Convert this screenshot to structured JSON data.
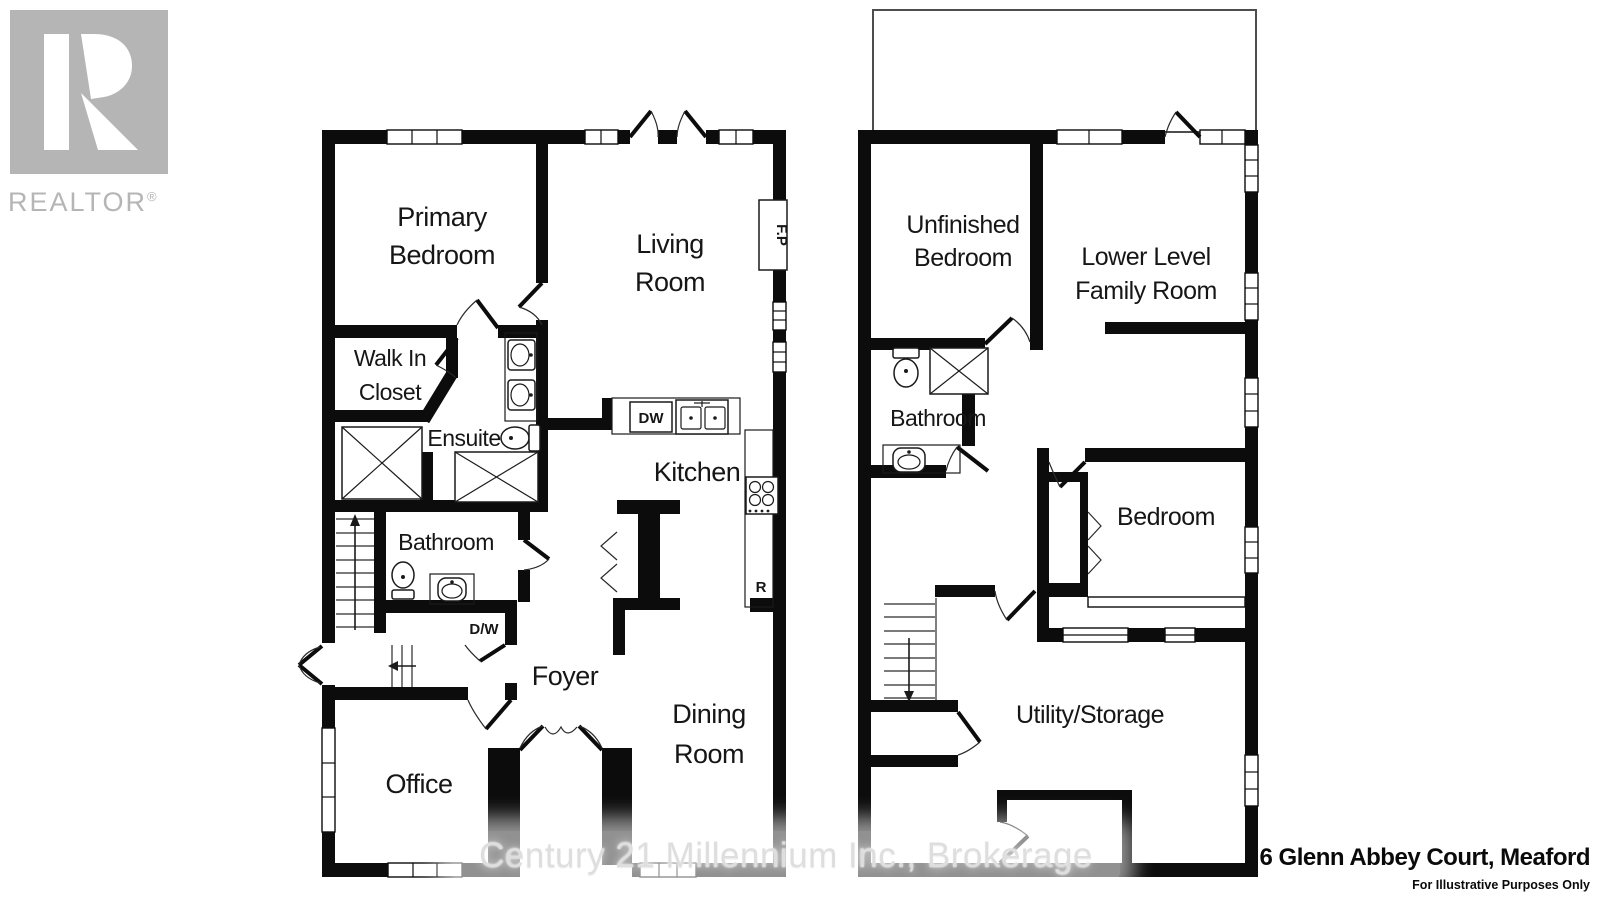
{
  "branding": {
    "logo_text": "REALTOR",
    "registered": "®"
  },
  "watermark": "Century 21 Millennium Inc., Brokerage",
  "footer": {
    "address": "6 Glenn Abbey Court, Meaford",
    "disclaimer": "For Illustrative Purposes Only"
  },
  "main_floor": {
    "primary_bedroom_1": "Primary",
    "primary_bedroom_2": "Bedroom",
    "living_room_1": "Living",
    "living_room_2": "Room",
    "walk_in_closet_1": "Walk In",
    "walk_in_closet_2": "Closet",
    "ensuite": "Ensuite",
    "bathroom": "Bathroom",
    "kitchen": "Kitchen",
    "foyer": "Foyer",
    "dining_room_1": "Dining",
    "dining_room_2": "Room",
    "office": "Office",
    "dishwasher": "DW",
    "laundry": "D/W",
    "fireplace": "F.P",
    "refrigerator": "R"
  },
  "lower_level": {
    "unfinished_bedroom_1": "Unfinished",
    "unfinished_bedroom_2": "Bedroom",
    "family_room_1": "Lower Level",
    "family_room_2": "Family Room",
    "bathroom": "Bathroom",
    "bedroom": "Bedroom",
    "utility": "Utility/Storage"
  }
}
